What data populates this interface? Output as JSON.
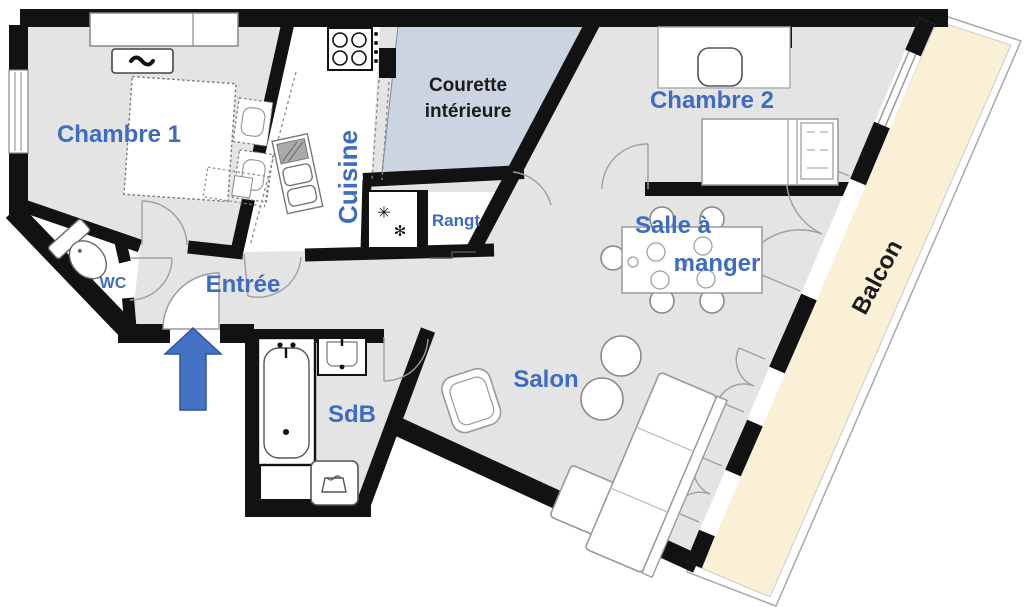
{
  "rooms": {
    "chambre1": {
      "label": "Chambre 1"
    },
    "cuisine": {
      "label": "Cuisine"
    },
    "courette": {
      "line1": "Courette",
      "line2": "intérieure"
    },
    "chambre2": {
      "label": "Chambre 2"
    },
    "rangt": {
      "label": "Rangt"
    },
    "wc": {
      "label": "WC"
    },
    "entree": {
      "label": "Entrée"
    },
    "salle_a_manger": {
      "line1": "Salle à",
      "line2": "manger"
    },
    "sdb": {
      "label": "SdB"
    },
    "salon": {
      "label": "Salon"
    },
    "balcon": {
      "label": "Balcon"
    }
  },
  "icons": {
    "freezer_snowflake_large": "✳",
    "freezer_snowflake_small": "✻"
  },
  "colors": {
    "wall": "#121212",
    "floor": "#e4e4e4",
    "courtyard": "#ccd4e1",
    "balcony": "#faf0d6",
    "label_blue": "#3d6cc0",
    "label_dark": "#1a1a1a",
    "arrow_fill": "#4472c4",
    "arrow_stroke": "#2f5597"
  }
}
